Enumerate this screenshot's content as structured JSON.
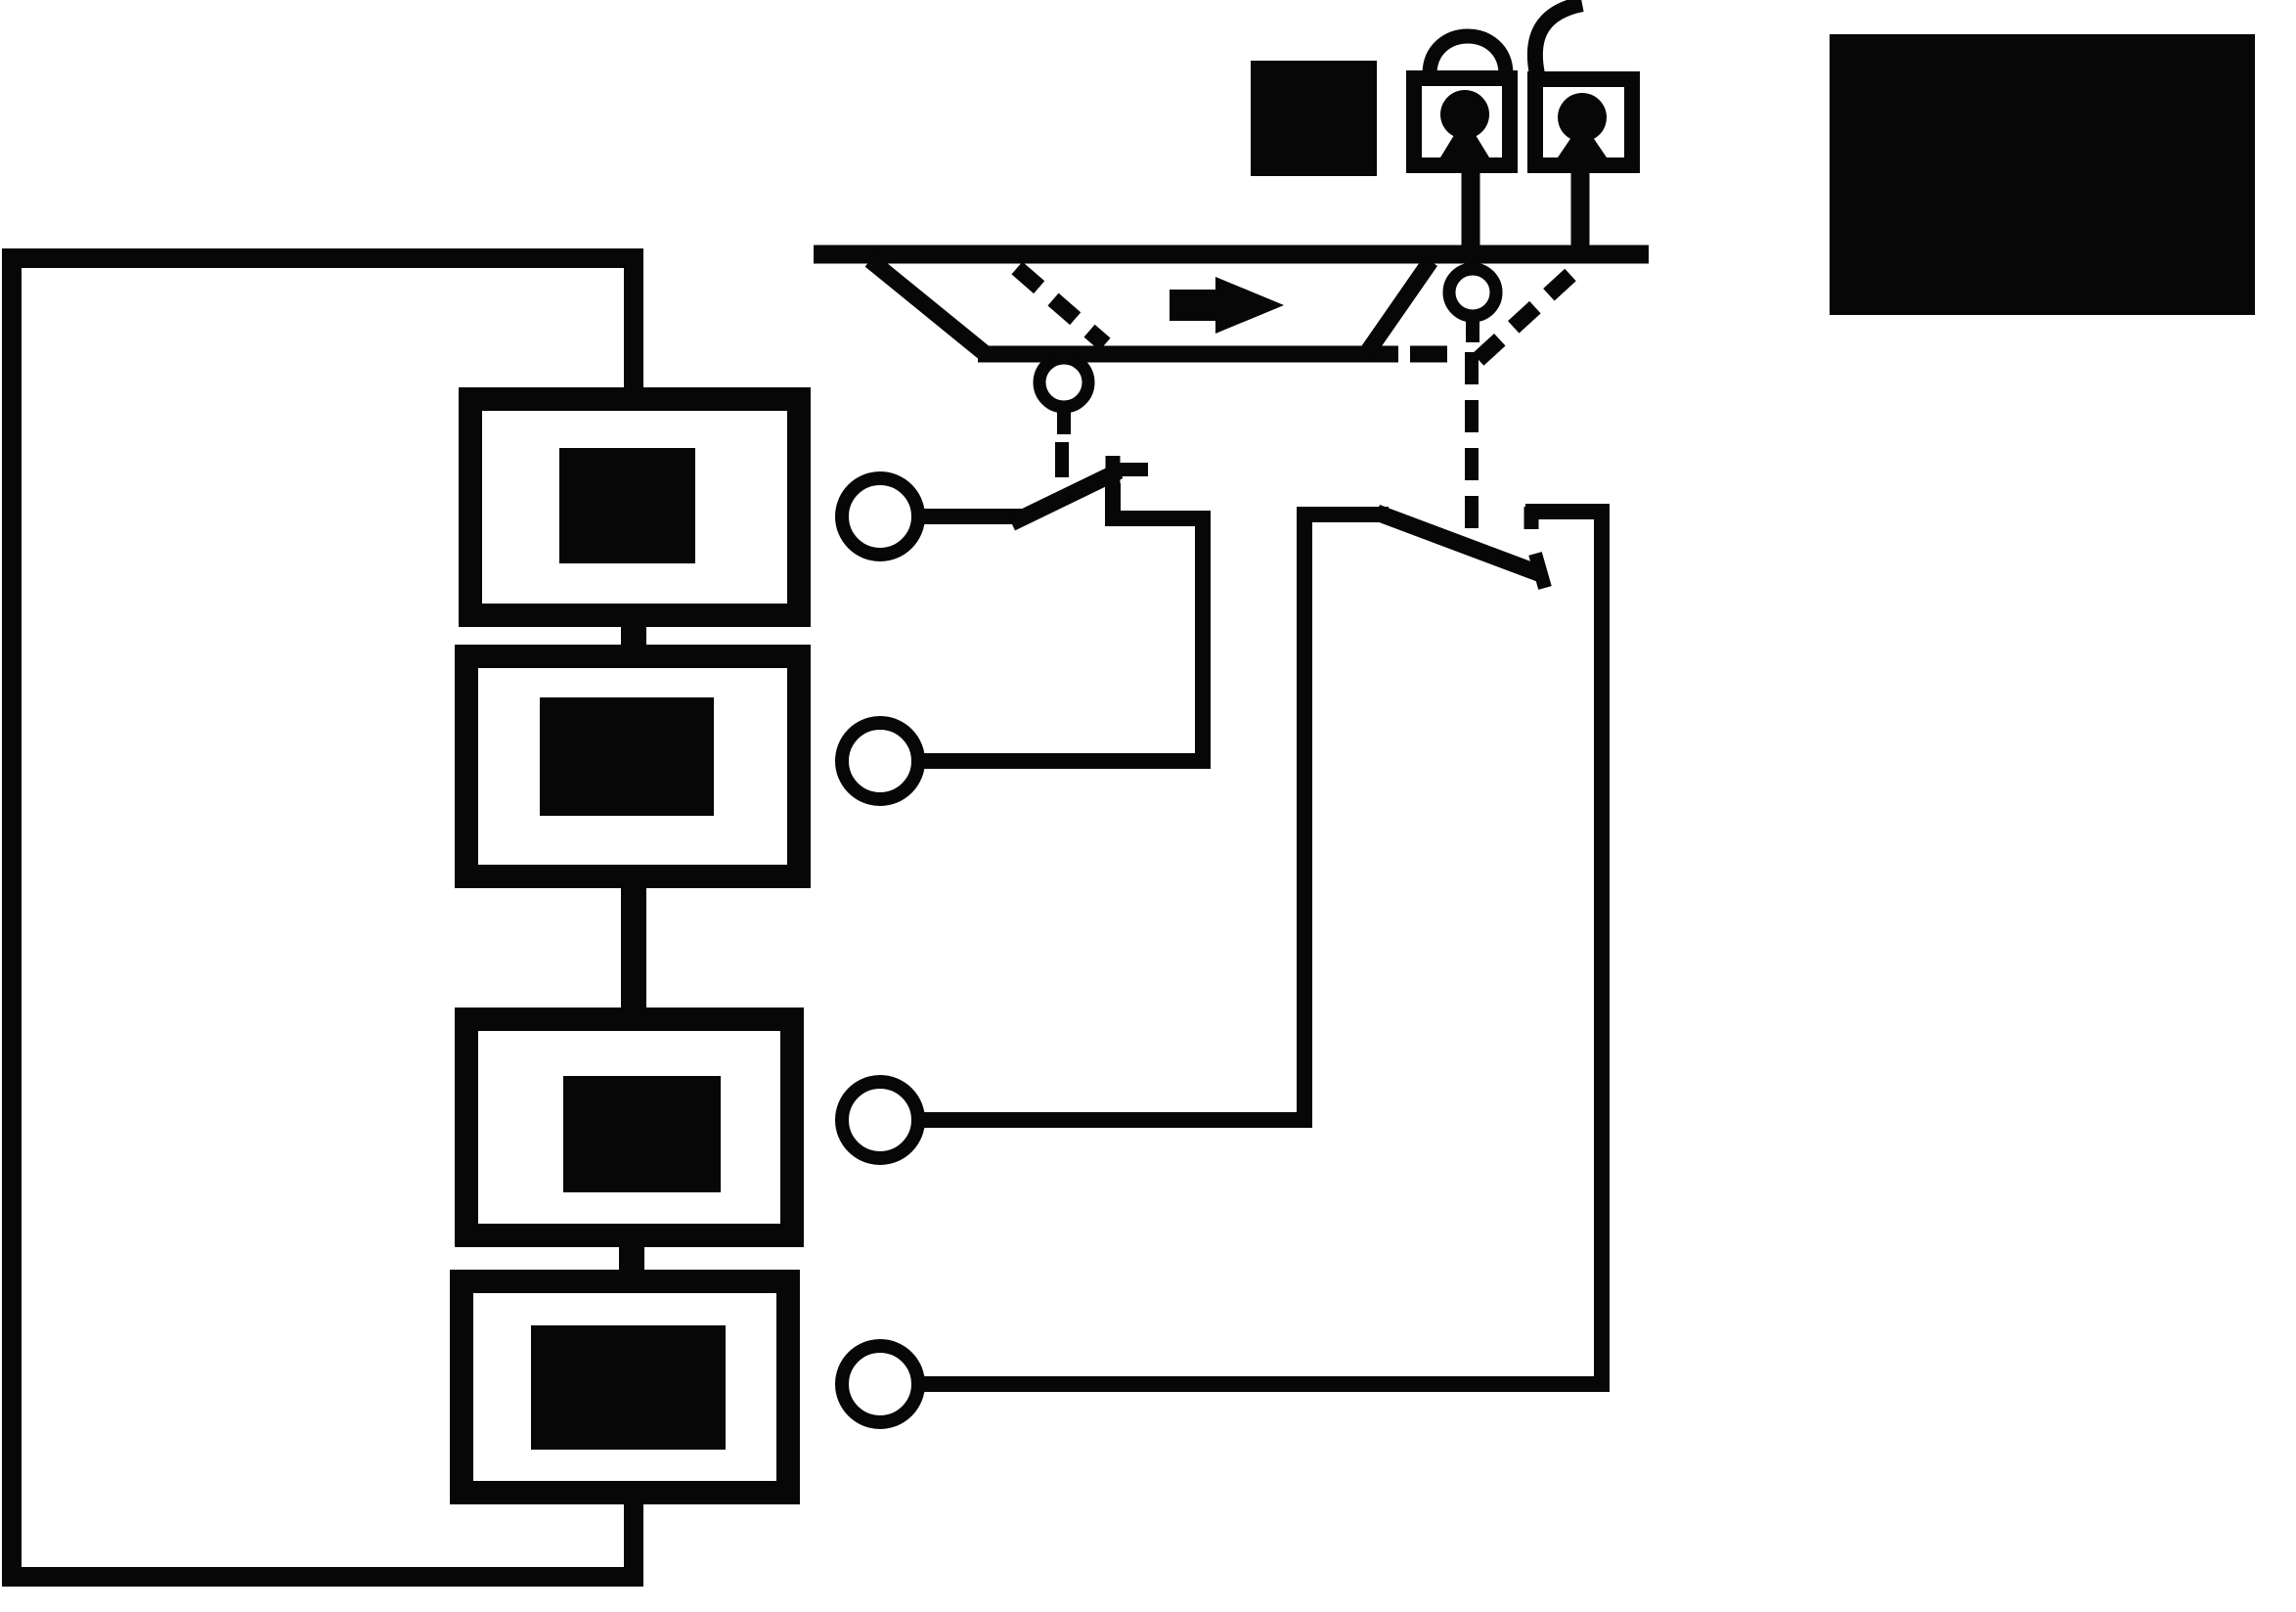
{
  "colors": {
    "ink": "#070707",
    "background": "#ffffff"
  },
  "diagram": {
    "type": "schematic",
    "description": "Monochrome wiring schematic: a duct rail with a pivoting flow vane (arrow pointing right) mechanically linked by dashed lines to two switches; the switches connect four ring terminals to a series chain of four boxed components inside a rectangular supply loop; two padlocks (one locked, one unlocked) and two solid black panels sit above the rail.",
    "flow_arrow_direction": "right",
    "counts": {
      "component_boxes": 4,
      "ring_terminals": 4,
      "switches": 2,
      "padlocks": 2,
      "solid_panels": 2,
      "pivot_rollers": 2
    },
    "switch_states": {
      "switch_1": "open",
      "switch_2": "open"
    },
    "padlock_states": {
      "left_padlock": "locked",
      "right_padlock": "unlocked"
    }
  }
}
